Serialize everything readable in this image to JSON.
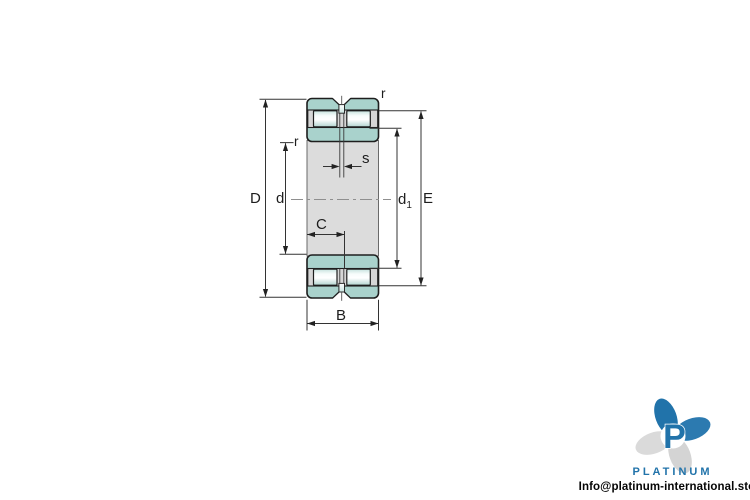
{
  "diagram": {
    "name": "double-row cylindrical roller bearing cross-section drawing",
    "labels": {
      "outer_diameter": "D",
      "bore_diameter": "d",
      "inner_shoulder_base": "d",
      "inner_shoulder_sub": "1",
      "outer_shoulder": "E",
      "width": "B",
      "rib_width": "C",
      "groove_width": "s",
      "radius_outer": "r",
      "radius_inner": "r"
    },
    "colors": {
      "ring_fill": "#a9d2cc",
      "roller_highlight": "#ffffff",
      "roller_shade": "#b7d8d4",
      "cage_fill": "#d6d6d6",
      "bore_fill": "#dcdcdc",
      "outline": "#1e1e1e",
      "dimension_line": "#333333",
      "centerline": "#8f8f8f"
    }
  },
  "branding": {
    "monogram": "P",
    "wordmark": "PLATINUM",
    "email": "Info@platinum-international.store",
    "colors": {
      "primary_blue": "#2173aa",
      "petal_gray": "#d4d4d4"
    }
  }
}
